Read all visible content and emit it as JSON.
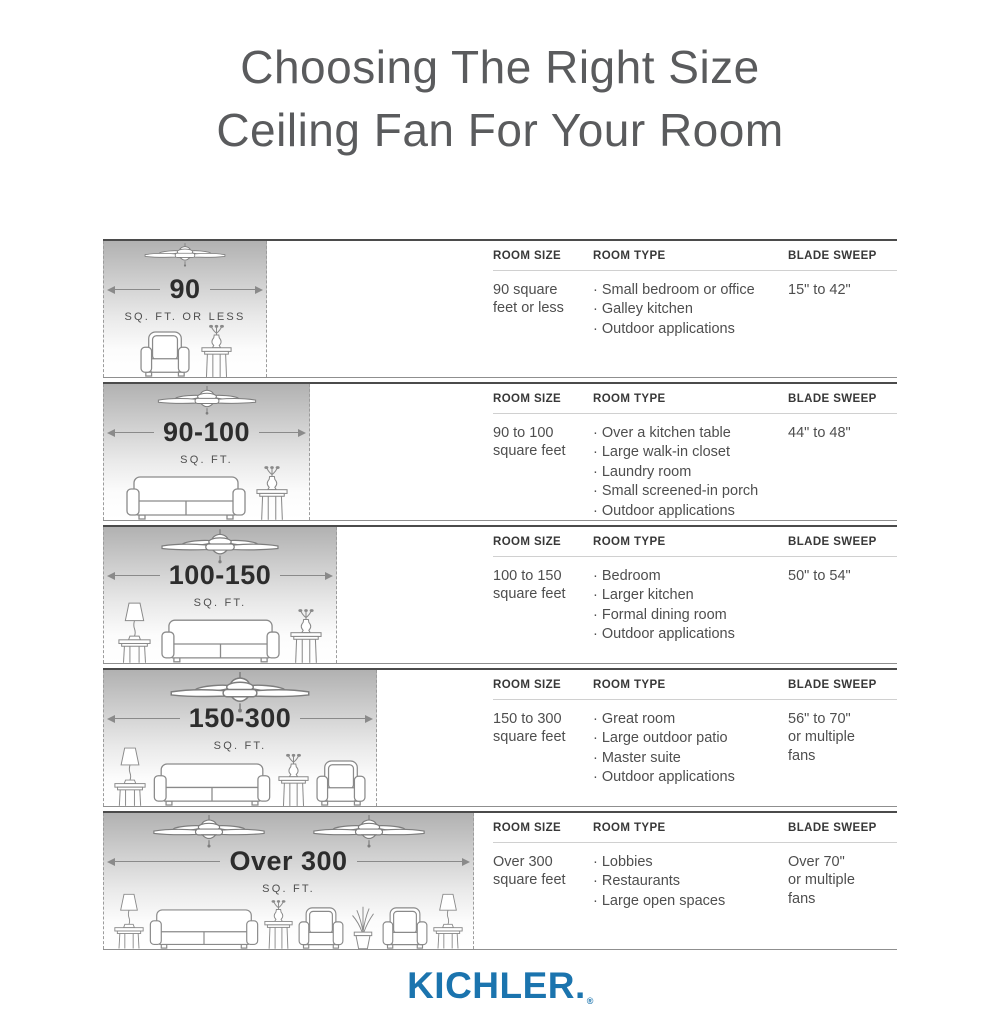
{
  "title": {
    "line1": "Choosing The Right Size",
    "line2": "Ceiling Fan For Your Room"
  },
  "table_headers": {
    "room_size": "ROOM SIZE",
    "room_type": "ROOM TYPE",
    "blade_sweep": "BLADE SWEEP"
  },
  "rows": [
    {
      "size_label": "90",
      "size_sublabel": "SQ. FT. OR LESS",
      "room_size": "90 square feet or less",
      "room_type": [
        "Small bedroom or office",
        "Galley kitchen",
        "Outdoor applications"
      ],
      "blade_sweep": "15\" to 42\""
    },
    {
      "size_label": "90-100",
      "size_sublabel": "SQ. FT.",
      "room_size": "90 to 100 square feet",
      "room_type": [
        "Over a kitchen table",
        "Large walk-in closet",
        "Laundry room",
        "Small screened-in porch",
        "Outdoor applications"
      ],
      "blade_sweep": "44\" to 48\""
    },
    {
      "size_label": "100-150",
      "size_sublabel": "SQ. FT.",
      "room_size": "100 to 150 square feet",
      "room_type": [
        "Bedroom",
        "Larger kitchen",
        "Formal dining room",
        "Outdoor applications"
      ],
      "blade_sweep": "50\" to 54\""
    },
    {
      "size_label": "150-300",
      "size_sublabel": "SQ. FT.",
      "room_size": "150 to 300 square feet",
      "room_type": [
        "Great room",
        "Large outdoor patio",
        "Master suite",
        "Outdoor applications"
      ],
      "blade_sweep": "56\" to 70\"\nor multiple\nfans"
    },
    {
      "size_label": "Over 300",
      "size_sublabel": "SQ. FT.",
      "room_size": "Over 300 square feet",
      "room_type": [
        "Lobbies",
        "Restaurants",
        "Large open spaces"
      ],
      "blade_sweep": "Over 70\"\nor multiple\nfans"
    }
  ],
  "logo": {
    "text": "KICHLER.",
    "registered_mark": "®"
  },
  "colors": {
    "logo_blue": "#1b74ae",
    "title_gray": "#5a5b5d",
    "row_border_dark": "#4b4b4b",
    "ground_line": "#8f8f8f",
    "illustration_gradient_top": "#b1b1b1"
  }
}
